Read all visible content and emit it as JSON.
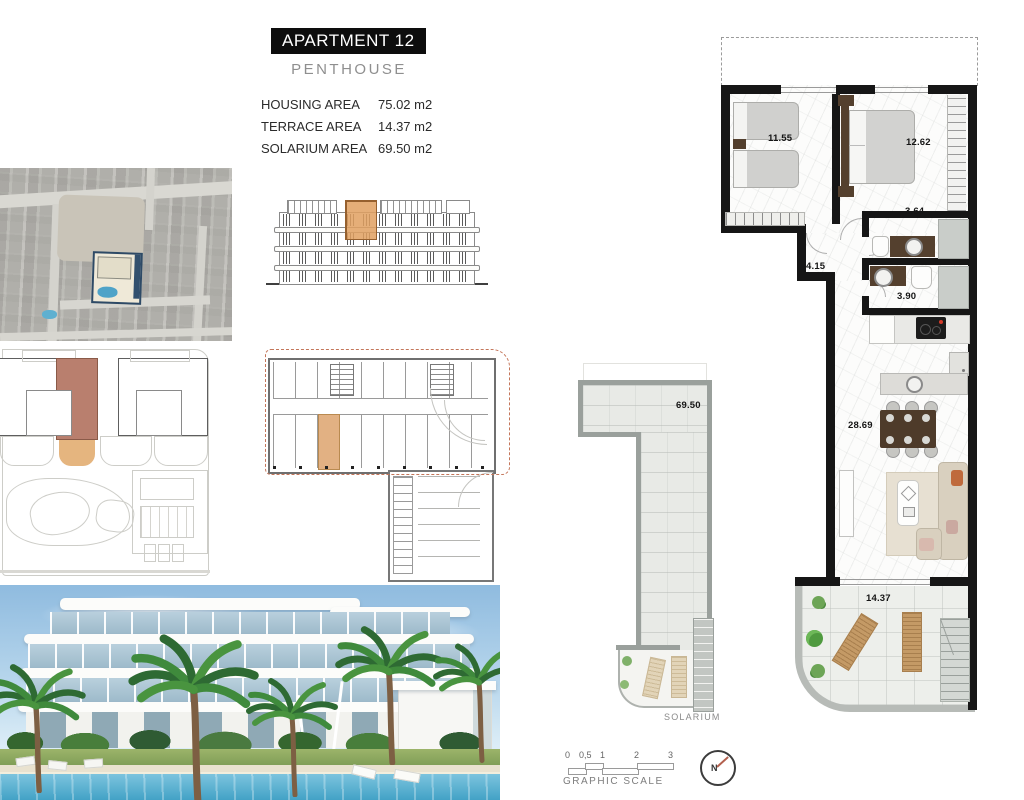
{
  "header": {
    "title": "APARTMENT 12",
    "subtitle": "PENTHOUSE",
    "areas": [
      {
        "label": "HOUSING AREA",
        "value": "75.02 m2"
      },
      {
        "label": "TERRACE AREA",
        "value": "14.37 m2"
      },
      {
        "label": "SOLARIUM AREA",
        "value": "69.50 m2"
      }
    ]
  },
  "floor_plan": {
    "bedroom1_area": "11.55",
    "bedroom2_area": "12.62",
    "bath1_area": "3.64",
    "hall_area": "4.15",
    "bath2_area": "3.90",
    "living_area": "28.69",
    "terrace_area": "14.37"
  },
  "solarium": {
    "area": "69.50",
    "caption": "SOLARIUM"
  },
  "scale": {
    "ticks": [
      "0",
      "0,5",
      "1",
      "2",
      "3"
    ],
    "label": "GRAPHIC SCALE"
  },
  "compass": {
    "label": "N"
  },
  "colors": {
    "highlight_unit": "#b97f6e",
    "highlight_terrace": "#e5b57f",
    "highlight_elevation": "#e0a060",
    "dashed_outline": "#c4765a",
    "compass_needle": "#b3604e",
    "wall": "#161616"
  }
}
